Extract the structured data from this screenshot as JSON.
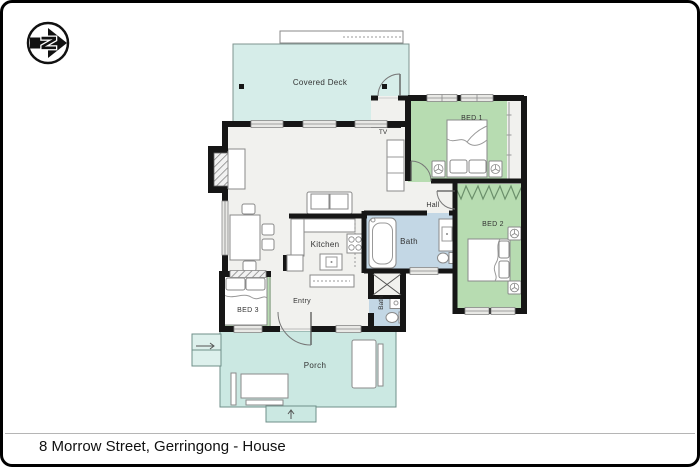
{
  "meta": {
    "width": 700,
    "height": 467,
    "type": "floorplan"
  },
  "compass": {
    "letter": "N"
  },
  "caption": {
    "text": "8 Morrow Street, Gerringong - House"
  },
  "labels": {
    "covered_deck": "Covered Deck",
    "tv": "TV",
    "bed1": "BED 1",
    "hall": "Hall",
    "bed2": "BED 2",
    "bath": "Bath",
    "kitchen": "Kitchen",
    "bed3": "BED 3",
    "entry": "Entry",
    "bath2": "Bath",
    "porch": "Porch"
  },
  "colors": {
    "deck": "#d6ede9",
    "porch": "#cbe8e2",
    "bedroom": "#b7dcb1",
    "bath": "#c3d7e5",
    "floor": "#f1f1ee",
    "wall": "#161616",
    "label": "#333333"
  }
}
